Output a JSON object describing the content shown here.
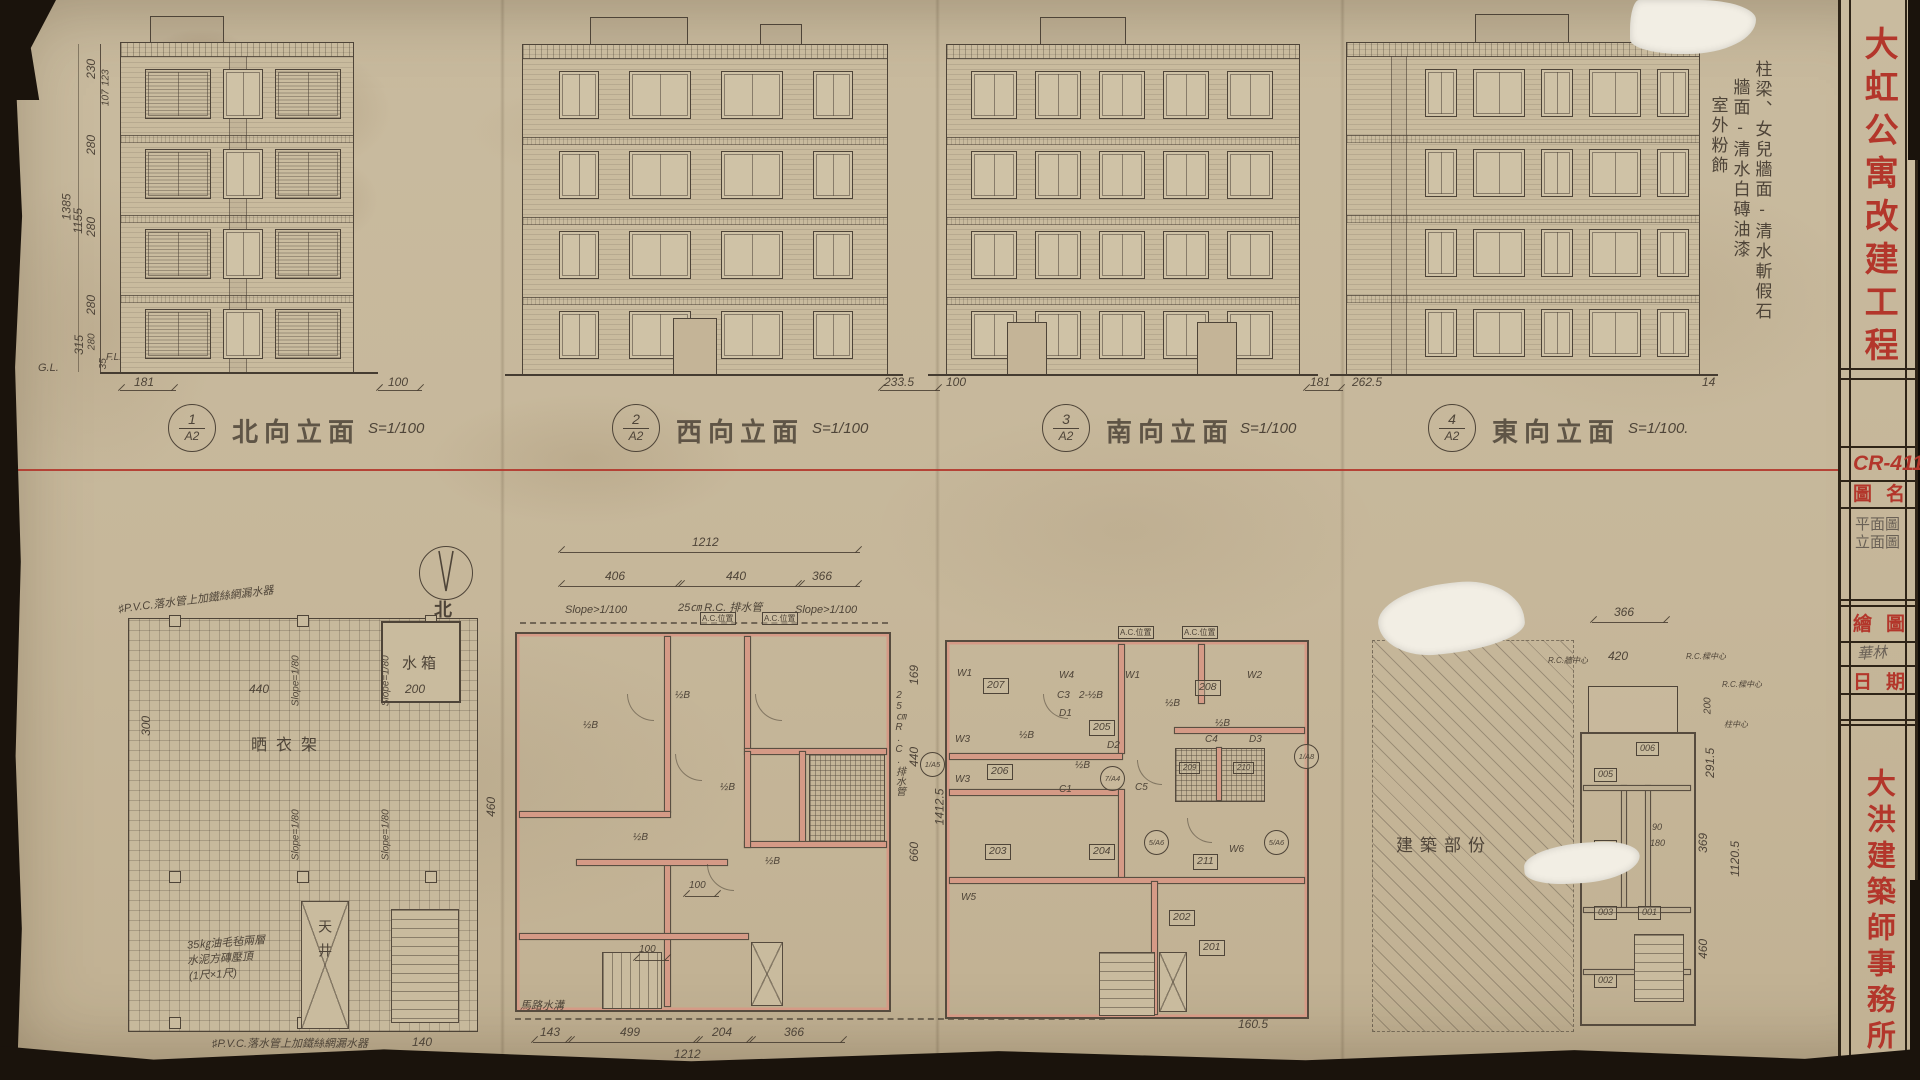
{
  "colors": {
    "paper": "#c8ba9f",
    "ink": "#4e4438",
    "red": "#b3362b",
    "wall_pink": "#d59a86"
  },
  "title_block": {
    "project_title": "大虹公寓改建工程",
    "drawing_no": "CR-411",
    "drawing_name_label": "圖名",
    "drawing_name_line1": "平面圖",
    "drawing_name_line2": "立面圖",
    "drafter_label": "繪圖",
    "drafter_signature": "華林",
    "date_label": "日期",
    "office_name": "大洪建築師事務所"
  },
  "finish_note": {
    "col1": "柱梁、女兒牆面-清水斬假石",
    "col2": "牆面-清水白磚油漆",
    "col3": "室外粉飾"
  },
  "elevations": [
    {
      "num": "1",
      "sheet": "A2",
      "name": "北向立面",
      "scale": "S=1/100"
    },
    {
      "num": "2",
      "sheet": "A2",
      "name": "西向立面",
      "scale": "S=1/100"
    },
    {
      "num": "3",
      "sheet": "A2",
      "name": "南向立面",
      "scale": "S=1/100"
    },
    {
      "num": "4",
      "sheet": "A2",
      "name": "東向立面",
      "scale": "S=1/100."
    }
  ],
  "left_dims": {
    "total1": "1385",
    "total2": "1155",
    "s230": "230",
    "s123": "123",
    "s107": "107",
    "s280a": "280",
    "s280b": "280",
    "s280c": "280",
    "s315": "315",
    "s280d": "280",
    "s35": "35",
    "gl": "G.L.",
    "fl": "F.L."
  },
  "base_dims": {
    "e1_left": "181",
    "e1_right": "100",
    "e3_left": "233.5",
    "e3_right": "100",
    "e4_left": "181",
    "e4_right": "262.5",
    "far_right": "14"
  },
  "compass": {
    "label": "北"
  },
  "roof_plan": {
    "slope": "Slope=1/80",
    "clothes_rack": "晒衣架",
    "water_tank": "水箱",
    "light_well": "天井",
    "note1": "35㎏油毛毡兩層",
    "note2": "水泥方磚壓頂",
    "note3": "(1尺×1尺)",
    "drain_note": "♯P.V.C.落水管上加鐵絲網漏水器",
    "d440": "440",
    "d200": "200",
    "d300": "300",
    "d460": "460",
    "d140": "140"
  },
  "floor_plan": {
    "top_total": "1212",
    "seg1": "406",
    "seg2": "440",
    "seg3": "366",
    "slope": "Slope>1/100",
    "drain": "25㎝ R.C. 排水管",
    "ac": "A.C.位置",
    "half_b": "½B",
    "d100": "100",
    "right_note": "25㎝R.C.排水管",
    "rd169": "169",
    "rd440": "440",
    "rd660": "660",
    "rd1412": "1412.5",
    "road": "馬路水溝",
    "b143": "143",
    "b499": "499",
    "b204": "204",
    "b366": "366",
    "bottom_total": "1212"
  },
  "unit_plan": {
    "ac": "A.C.位置",
    "half_b": "½B",
    "two_half_b": "2-½B",
    "rooms": {
      "r201": "201",
      "r202": "202",
      "r203": "203",
      "r204": "204",
      "r205": "205",
      "r206": "206",
      "r207": "207",
      "r208": "208",
      "r209": "209",
      "r210": "210",
      "r211": "211"
    },
    "w1": "W1",
    "w2": "W2",
    "w3": "W3",
    "w4": "W4",
    "w5": "W5",
    "w6": "W6",
    "d1": "D1",
    "d2": "D2",
    "d3": "D3",
    "c1": "C1",
    "c3": "C3",
    "c4": "C4",
    "c5": "C5",
    "b_a5": "1/A5",
    "b_a4": "7/A4",
    "b_a6": "5/A6",
    "b_a8": "1/A8",
    "dim160": "160.5"
  },
  "partial_plan": {
    "area": "建築部份",
    "rooms": {
      "r001": "001",
      "r002": "002",
      "r003": "003",
      "r004": "004",
      "r005": "005",
      "r006": "006"
    },
    "d366": "366",
    "d420": "420",
    "d90": "90",
    "d180": "180",
    "d200": "200",
    "d291": "291.5",
    "d369": "369",
    "d1120": "1120.5",
    "d460": "460",
    "wall_c": "R.C.牆中心",
    "beam_c": "R.C.樑中心",
    "col_c": "柱中心"
  }
}
